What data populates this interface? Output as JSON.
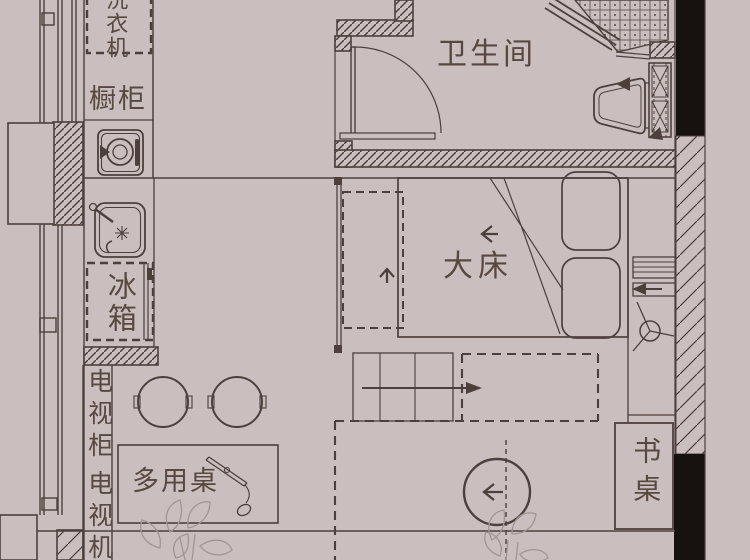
{
  "plan": {
    "title": "apartment-floor-plan",
    "labels": {
      "washing_machine": "洗衣机",
      "cabinet": "橱柜",
      "fridge": "冰箱",
      "tv_cabinet": "电视柜",
      "tv": "电视机",
      "multi_table": "多用桌",
      "bathroom": "卫生间",
      "bed": "大床",
      "desk": "书桌"
    },
    "colors": {
      "background": "#cabebe",
      "line": "#4d403c",
      "wall_black": "#171110",
      "text": "#57493f",
      "plant_line": "#a39593"
    },
    "symbols": [
      "door-swing-icon",
      "stove-burner-icon",
      "kitchen-sink-icon",
      "toilet-icon",
      "shower-tile-icon",
      "pipe-shaft-icon",
      "radiator-icon",
      "ceiling-fan-icon",
      "pillow-icon",
      "steps-icon",
      "stool-icon",
      "round-table-icon",
      "desk-lamp-icon",
      "plant-icon",
      "arrow-right-icon",
      "arrow-left-icon",
      "arrow-up-icon"
    ]
  }
}
